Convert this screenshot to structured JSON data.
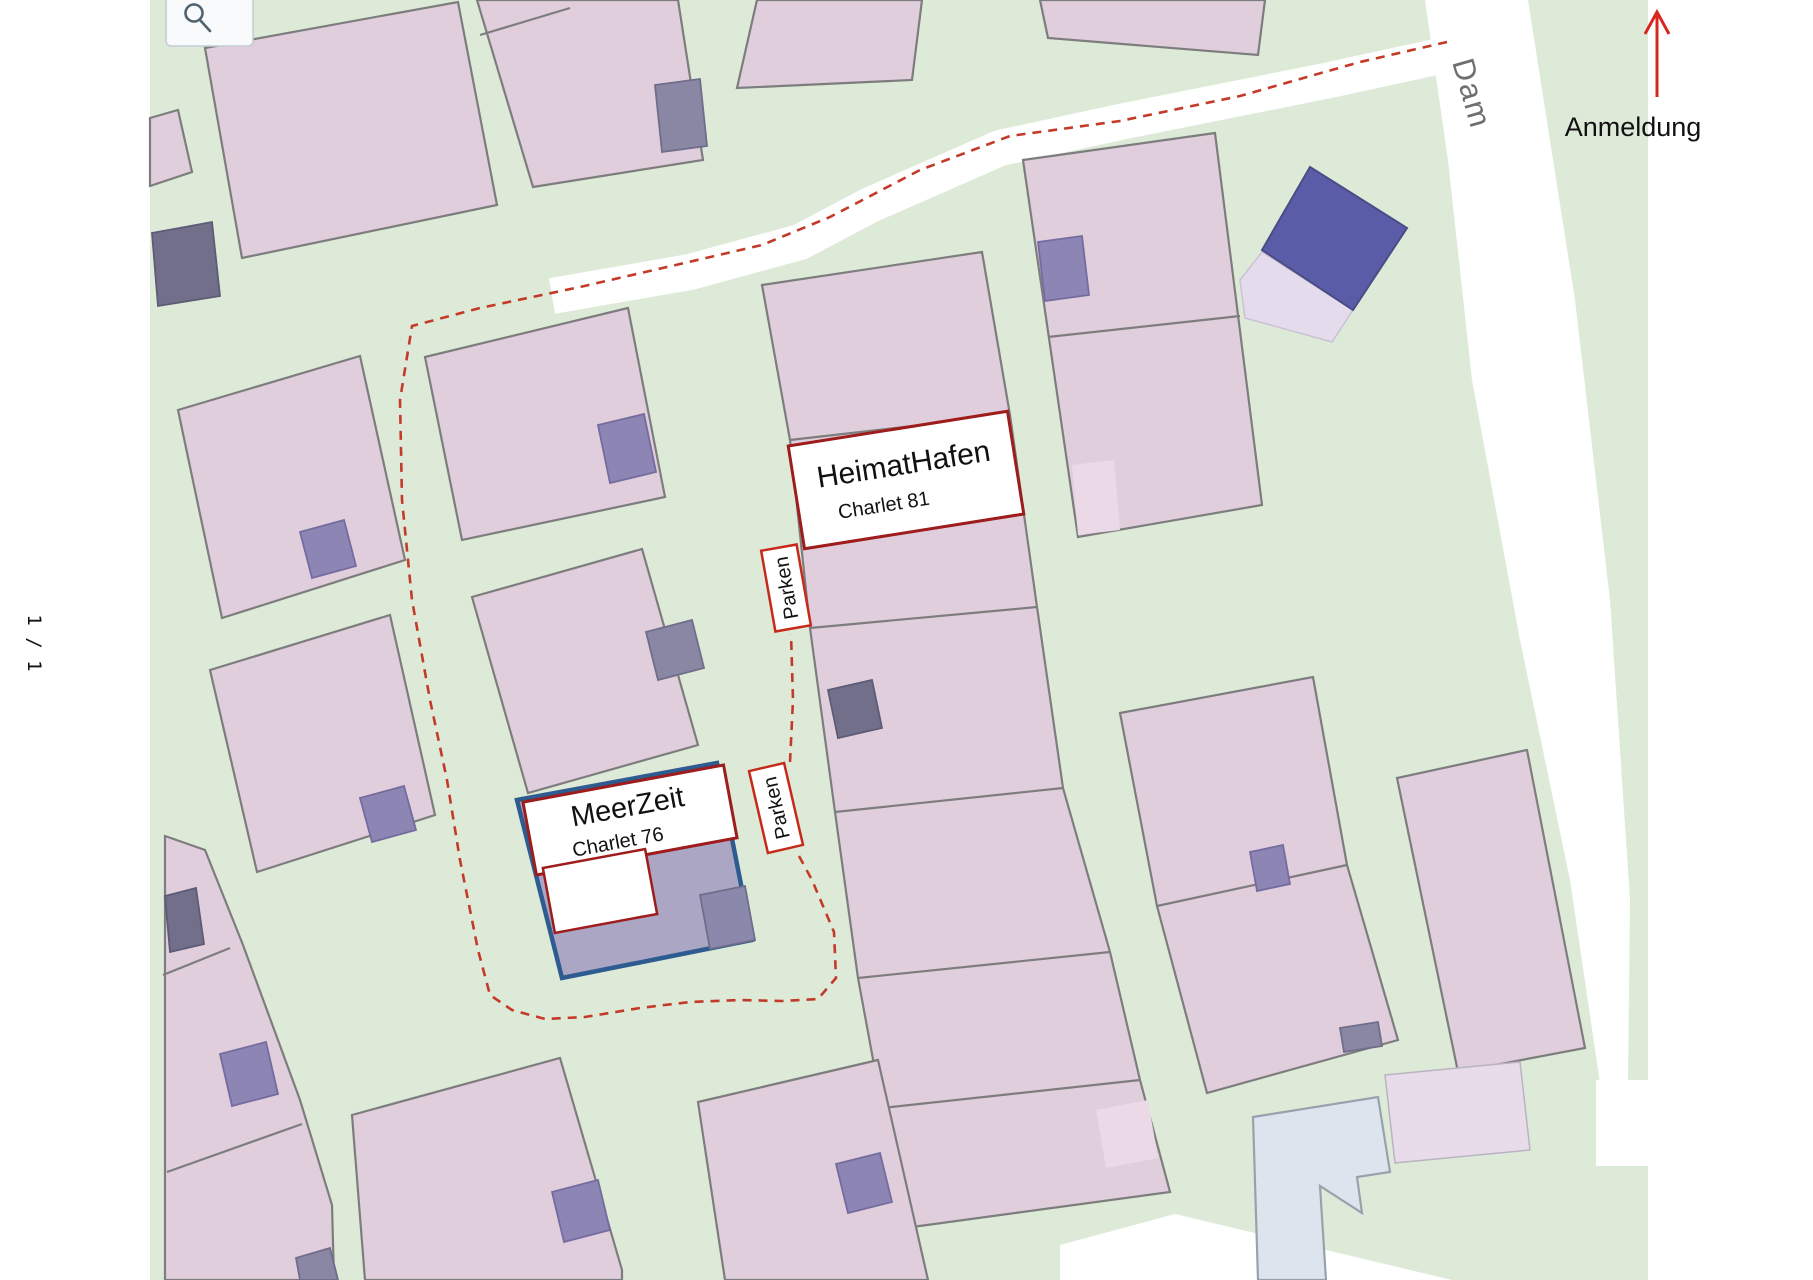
{
  "viewer": {
    "search_button": {
      "icon": "magnifier-icon"
    },
    "page_indicator": "1 / 1"
  },
  "map": {
    "street_name": "Dam",
    "annotations": {
      "anmeldung": {
        "label": "Anmeldung",
        "arrow_direction": "up"
      },
      "heimathafen": {
        "title": "HeimatHafen",
        "subtitle": "Charlet 81"
      },
      "meerzeit": {
        "title": "MeerZeit",
        "subtitle": "Charlet 76"
      },
      "parken_north": {
        "label": "Parken"
      },
      "parken_south": {
        "label": "Parken"
      }
    },
    "colors": {
      "ground_green": "#deead8",
      "parcel_pink": "#e1cedd",
      "parcel_outline_gray": "#7d7d7d",
      "shed_purple": "#8d85b3",
      "shed_gray_purple": "#8a87a5",
      "shed_dark": "#716f8a",
      "building_navy": "#5a5ca8",
      "building_light_blue": "#dce5ee",
      "meerzeit_plot_fill": "#aba6c3",
      "meerzeit_plot_outline_blue": "#2e5b90",
      "label_border_dark_red": "#9e1c1c",
      "label_border_red": "#c62a1a",
      "route_dashed_red": "#c43a28",
      "arrow_red": "#d6281e",
      "street_text_gray": "#6f6f6f"
    }
  }
}
